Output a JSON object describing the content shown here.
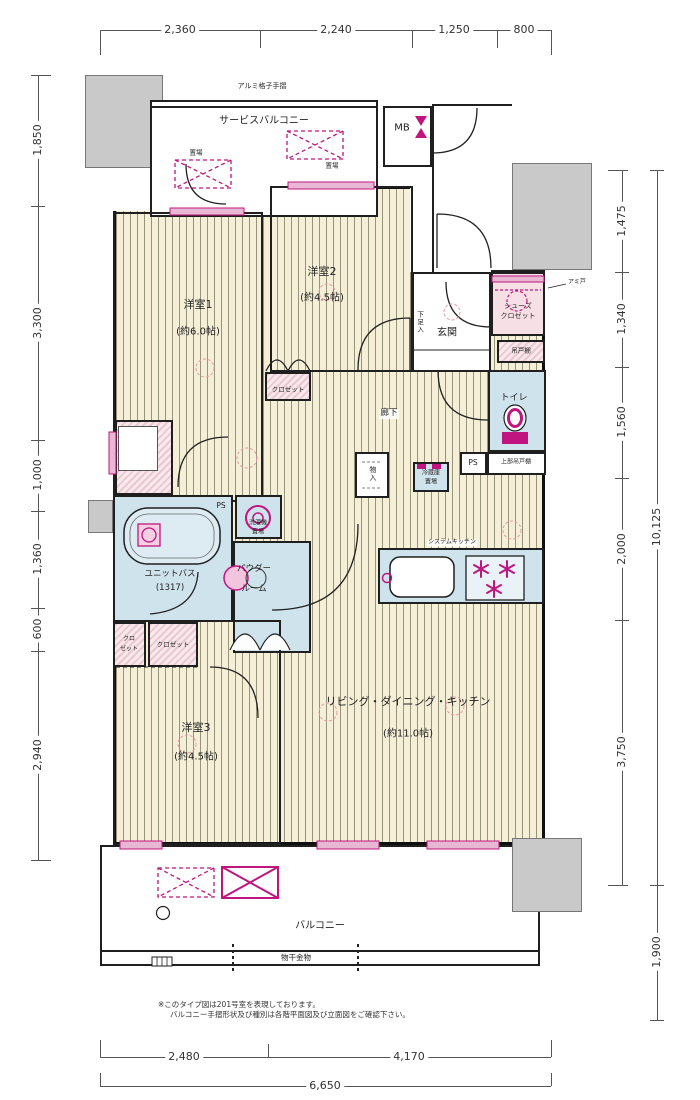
{
  "dimensions": {
    "top": [
      "2,360",
      "2,240",
      "1,250",
      "800"
    ],
    "left": [
      "1,850",
      "3,300",
      "1,000",
      "1,360",
      "600",
      "2,940"
    ],
    "right": [
      "1,475",
      "1,340",
      "1,560",
      "2,000",
      "3,750"
    ],
    "right_total": "10,125",
    "right_lower": "1,900",
    "bottom": [
      "2,480",
      "4,170"
    ],
    "bottom_total": "6,650"
  },
  "rooms": {
    "service_balcony": "サービスバルコニー",
    "mb": "MB",
    "room1": "洋室1",
    "room1_size": "(約6.0帖)",
    "room2": "洋室2",
    "room2_size": "(約4.5帖)",
    "room3": "洋室3",
    "room3_size": "(約4.5帖)",
    "ldk": "リビング・ダイニング・キッチン",
    "ldk_size": "(約11.0帖)",
    "genkan": "玄関",
    "toilet": "トイレ",
    "corridor": "廊下",
    "unit_bath": "ユニットバス",
    "unit_bath_size": "(1317)",
    "powder_line1": "パウダー",
    "powder_line2": "ルーム",
    "balcony": "バルコニー"
  },
  "fixtures": {
    "handrail": "アルミ格子手摺",
    "shoes_line1": "シューズ",
    "shoes_line2": "クロゼット",
    "getabako": "下足入",
    "tsuridana": "吊戸棚",
    "closet": "クロゼット",
    "closet_s1": "クロ",
    "closet_s2": "ゼット",
    "monoire": "物入",
    "fridge_line1": "冷蔵庫",
    "fridge_line2": "置場",
    "laundry_line1": "洗濯機",
    "laundry_line2": "置場",
    "ps": "PS",
    "upper_cabinet": "上部吊戸棚",
    "kitchen": "システムキッチン",
    "hanger": "物干金物",
    "okiba": "置場",
    "amido": "アミ戸"
  },
  "notes": {
    "line1": "※このタイプ図は201号室を表現しております。",
    "line2": "バルコニー手摺形状及び種別は各階平面図及び立面図をご確認下さい。"
  },
  "colors": {
    "accent_magenta": "#c0157e",
    "floor_cream": "#f5efd7",
    "wet_blue": "#cfe3ec",
    "closet_pink": "#f6e0e5",
    "common_gray": "#c9c9c9"
  }
}
